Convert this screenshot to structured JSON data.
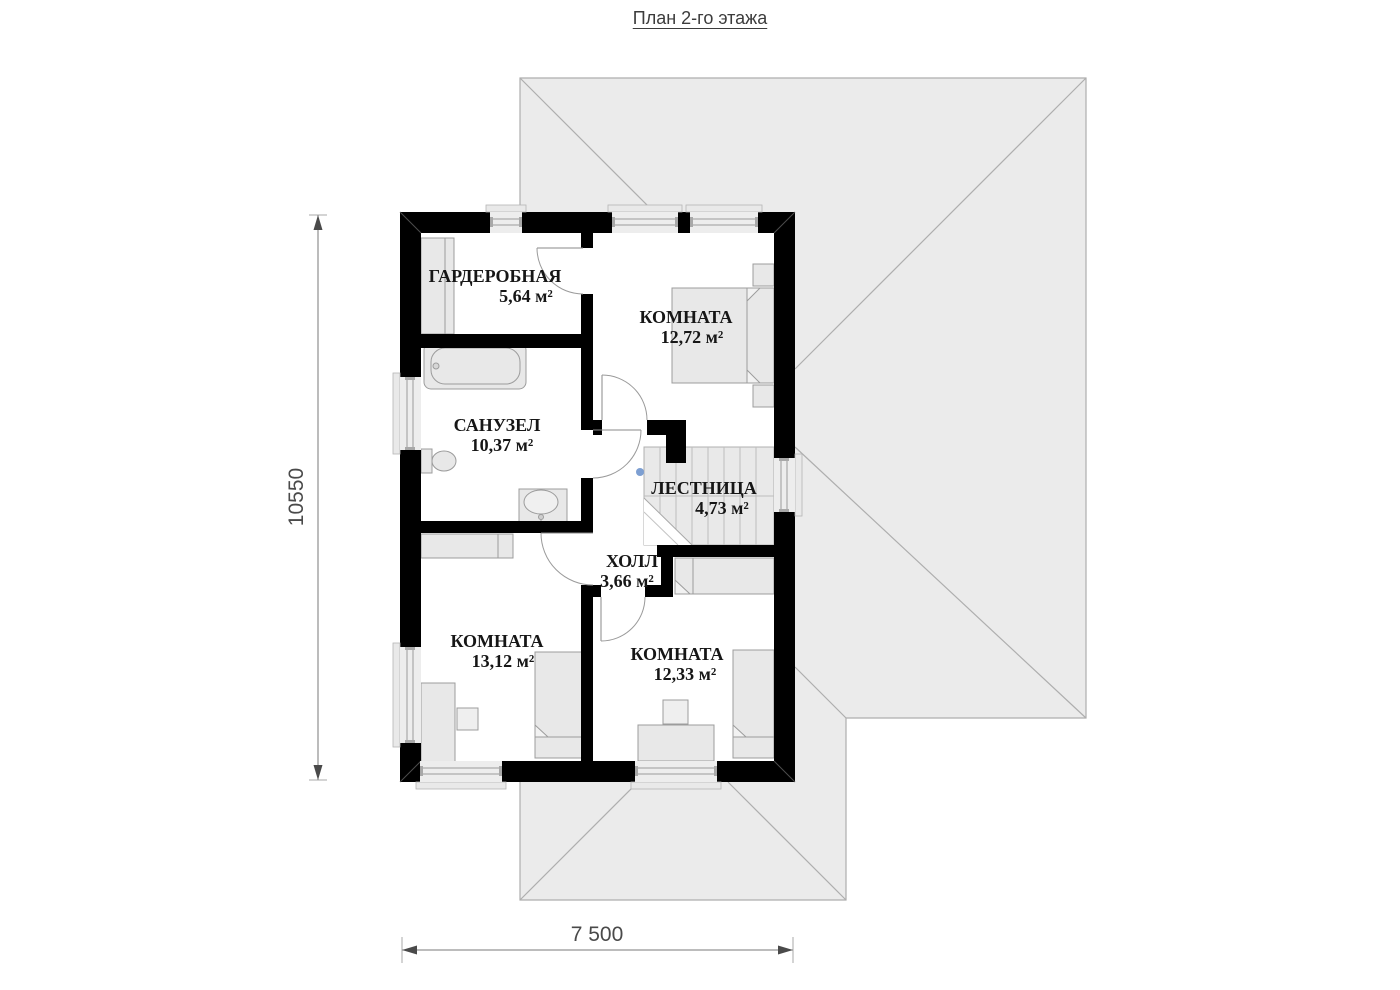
{
  "title": "План 2-го этажа",
  "rooms": [
    {
      "id": "wardrobe",
      "name": "ГАРДЕРОБНАЯ",
      "area": "5,64 м²"
    },
    {
      "id": "bedroom-top",
      "name": "КОМНАТА",
      "area": "12,72 м²"
    },
    {
      "id": "bathroom",
      "name": "САНУЗЕЛ",
      "area": "10,37 м²"
    },
    {
      "id": "staircase",
      "name": "ЛЕСТНИЦА",
      "area": "4,73 м²"
    },
    {
      "id": "hall",
      "name": "ХОЛЛ",
      "area": "3,66 м²"
    },
    {
      "id": "bedroom-left",
      "name": "КОМНАТА",
      "area": "13,12 м²"
    },
    {
      "id": "bedroom-right",
      "name": "КОМНАТА",
      "area": "12,33 м²"
    }
  ],
  "dimensions": {
    "vertical_total": "10550",
    "horizontal_total": "7 500"
  },
  "colors": {
    "wall": "#000000",
    "roof_fill": "#ebebeb",
    "roof_line": "#aeaeae",
    "furniture_fill": "#e8e8e8",
    "furniture_line": "#9c9c9c",
    "window_fill": "#ededed",
    "dim_line": "#4a4a4a",
    "label_text": "#161616",
    "marker_dot": "#7d9fd2"
  }
}
